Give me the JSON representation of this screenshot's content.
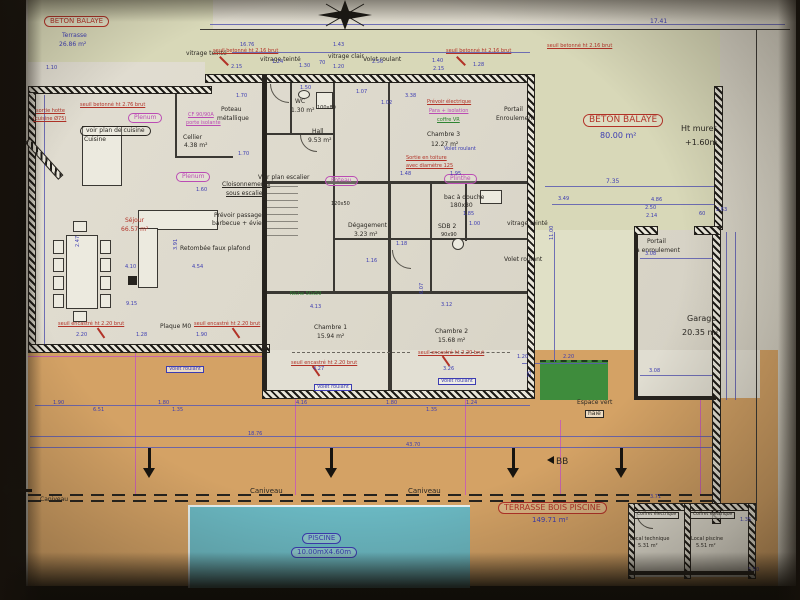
{
  "document": {
    "kind": "architectural floor plan (photograph)",
    "section_mark": "BB"
  },
  "palette": {
    "blue": "#3c3cb2",
    "red": "#b23227",
    "mag": "#bb4cb4",
    "blk": "#2a2722",
    "grn": "#2e8432",
    "paper": "#ddd9cd",
    "khaki": "#d8d8b8",
    "tan": "#d4a265",
    "pool": "#6ab8c2",
    "green": "#3e8c3c",
    "wall": "#26231e"
  },
  "rooms": [
    {
      "name": "Séjour",
      "area": "66.57 m²"
    },
    {
      "name": "Cuisine",
      "area": ""
    },
    {
      "name": "Cellier",
      "area": "4.38 m²"
    },
    {
      "name": "WC",
      "area": "1.30 m²"
    },
    {
      "name": "Hall",
      "area": "9.53 m²"
    },
    {
      "name": "Dégagement",
      "area": "3.23 m²"
    },
    {
      "name": "SDB 2",
      "area": ""
    },
    {
      "name": "Chambre 1",
      "area": "15.94 m²"
    },
    {
      "name": "Chambre 2",
      "area": "15.68 m²"
    },
    {
      "name": "Chambre 3",
      "area": "12.27 m²"
    },
    {
      "name": "Garage",
      "area": "20.35 m²"
    },
    {
      "name": "Local technique",
      "area": "5.31 m²"
    },
    {
      "name": "Local piscine",
      "area": "5.51 m²"
    },
    {
      "name": "Terrasse béton balayé",
      "area": "26.86 m²"
    },
    {
      "name": "Béton balayé",
      "area": "80.00 m²"
    },
    {
      "name": "Terrasse bois piscine",
      "area": "149.71 m²"
    },
    {
      "name": "Piscine",
      "area": "10.00mX4.60m"
    }
  ],
  "labels": [
    {
      "t": "BETON BALAYE",
      "x": 44,
      "y": 16,
      "s": 7,
      "c": "red",
      "o": 1,
      "n": "beton-balaye-nw-title"
    },
    {
      "t": "Terrasse",
      "x": 62,
      "y": 33,
      "s": 6,
      "c": "blue"
    },
    {
      "t": "26.86 m²",
      "x": 59,
      "y": 42,
      "s": 6,
      "c": "blue"
    },
    {
      "t": "BETON BALAYE",
      "x": 583,
      "y": 114,
      "s": 9,
      "c": "red",
      "o": 1,
      "n": "beton-balaye-e-title"
    },
    {
      "t": "80.00 m²",
      "x": 600,
      "y": 132,
      "s": 8,
      "c": "blue"
    },
    {
      "t": "TERRASSE BOIS PISCINE",
      "x": 498,
      "y": 502,
      "s": 8,
      "c": "red",
      "o": 1,
      "n": "terrasse-bois-title"
    },
    {
      "t": "149.71 m²",
      "x": 532,
      "y": 517,
      "s": 7,
      "c": "blue"
    },
    {
      "t": "PISCINE",
      "x": 302,
      "y": 533,
      "s": 7,
      "c": "blue",
      "o": 1,
      "n": "piscine-title"
    },
    {
      "t": "10.00mX4.60m",
      "x": 291,
      "y": 547,
      "s": 7,
      "c": "blue",
      "o": 1
    },
    {
      "t": "voir plan de cuisine",
      "x": 80,
      "y": 126,
      "s": 6,
      "c": "blk",
      "o": 1
    },
    {
      "t": "Plenum",
      "x": 128,
      "y": 113,
      "s": 6,
      "c": "mag",
      "o": 1
    },
    {
      "t": "Plenum",
      "x": 176,
      "y": 172,
      "s": 6,
      "c": "mag",
      "o": 1
    },
    {
      "t": "Poteau",
      "x": 325,
      "y": 176,
      "s": 6,
      "c": "mag",
      "o": 1
    },
    {
      "t": "Plinthe",
      "x": 444,
      "y": 174,
      "s": 6,
      "c": "mag",
      "o": 1
    },
    {
      "t": "Ht muret",
      "x": 681,
      "y": 125,
      "s": 8,
      "c": "blk"
    },
    {
      "t": "+1.60m",
      "x": 685,
      "y": 139,
      "s": 8,
      "c": "blk"
    },
    {
      "t": "Garage",
      "x": 687,
      "y": 315,
      "s": 8,
      "c": "blk"
    },
    {
      "t": "20.35 m²",
      "x": 682,
      "y": 329,
      "s": 8,
      "c": "blk"
    },
    {
      "t": "Portail",
      "x": 647,
      "y": 239,
      "s": 6,
      "c": "blk"
    },
    {
      "t": "à enroulement",
      "x": 636,
      "y": 248,
      "s": 6,
      "c": "blk"
    },
    {
      "t": "Portail",
      "x": 504,
      "y": 107,
      "s": 6,
      "c": "blk"
    },
    {
      "t": "Enroulement",
      "x": 496,
      "y": 116,
      "s": 6,
      "c": "blk"
    },
    {
      "t": "Espace vert",
      "x": 577,
      "y": 400,
      "s": 6,
      "c": "blk"
    },
    {
      "t": "haie",
      "x": 585,
      "y": 410,
      "s": 6,
      "c": "blk",
      "b": 1
    },
    {
      "t": "Caniveau",
      "x": 250,
      "y": 488,
      "s": 7,
      "c": "blk"
    },
    {
      "t": "Caniveau",
      "x": 408,
      "y": 488,
      "s": 7,
      "c": "blk"
    },
    {
      "t": "Caniveau",
      "x": 40,
      "y": 497,
      "s": 6,
      "c": "blk"
    },
    {
      "t": "BB",
      "x": 556,
      "y": 458,
      "s": 9,
      "c": "blk",
      "n": "section-mark-bb"
    },
    {
      "t": "Poteau",
      "x": 221,
      "y": 107,
      "s": 6,
      "c": "blk"
    },
    {
      "t": "métallique",
      "x": 217,
      "y": 116,
      "s": 6,
      "c": "blk"
    },
    {
      "t": "Cloisonnements",
      "x": 222,
      "y": 182,
      "s": 6,
      "c": "blk",
      "u": 1
    },
    {
      "t": "sous escalier",
      "x": 226,
      "y": 191,
      "s": 6,
      "c": "blk",
      "u": 1
    },
    {
      "t": "Voir plan escalier",
      "x": 258,
      "y": 175,
      "s": 6,
      "c": "blk"
    },
    {
      "t": "Retombée faux plafond",
      "x": 180,
      "y": 246,
      "s": 6,
      "c": "blk"
    },
    {
      "t": "Prévoir passage",
      "x": 214,
      "y": 213,
      "s": 6,
      "c": "blk"
    },
    {
      "t": "barbecue + évier",
      "x": 212,
      "y": 221,
      "s": 6,
      "c": "blk"
    },
    {
      "t": "Plaque M0",
      "x": 160,
      "y": 324,
      "s": 6,
      "c": "blk"
    },
    {
      "t": "Cuisine",
      "x": 84,
      "y": 137,
      "s": 6,
      "c": "blk"
    },
    {
      "t": "Cellier",
      "x": 183,
      "y": 135,
      "s": 6,
      "c": "blk"
    },
    {
      "t": "4.38 m²",
      "x": 184,
      "y": 143,
      "s": 6,
      "c": "blk"
    },
    {
      "t": "vitrage teinté",
      "x": 186,
      "y": 51,
      "s": 6,
      "c": "blk"
    },
    {
      "t": "vitrage teinté",
      "x": 260,
      "y": 57,
      "s": 6,
      "c": "blk"
    },
    {
      "t": "vitrage clair",
      "x": 328,
      "y": 54,
      "s": 6,
      "c": "blk"
    },
    {
      "t": "Volet roulant",
      "x": 363,
      "y": 57,
      "s": 6,
      "c": "blk"
    },
    {
      "t": "vitrage teinté",
      "x": 507,
      "y": 221,
      "s": 6,
      "c": "blk"
    },
    {
      "t": "Volet roulant",
      "x": 504,
      "y": 257,
      "s": 6,
      "c": "blk"
    },
    {
      "t": "WC",
      "x": 295,
      "y": 99,
      "s": 6,
      "c": "blk"
    },
    {
      "t": "1.30 m²",
      "x": 291,
      "y": 108,
      "s": 6,
      "c": "blk"
    },
    {
      "t": "100x80",
      "x": 317,
      "y": 106,
      "s": 5,
      "c": "blk"
    },
    {
      "t": "Hall",
      "x": 312,
      "y": 129,
      "s": 6,
      "c": "blk"
    },
    {
      "t": "9.53 m²",
      "x": 308,
      "y": 138,
      "s": 6,
      "c": "blk"
    },
    {
      "t": "Chambre 3",
      "x": 427,
      "y": 132,
      "s": 6,
      "c": "blk"
    },
    {
      "t": "12.27 m²",
      "x": 431,
      "y": 142,
      "s": 6,
      "c": "blk"
    },
    {
      "t": "Chambre 1",
      "x": 314,
      "y": 325,
      "s": 6,
      "c": "blk"
    },
    {
      "t": "15.94 m²",
      "x": 317,
      "y": 334,
      "s": 6,
      "c": "blk"
    },
    {
      "t": "Chambre 2",
      "x": 435,
      "y": 329,
      "s": 6,
      "c": "blk"
    },
    {
      "t": "15.68 m²",
      "x": 438,
      "y": 338,
      "s": 6,
      "c": "blk"
    },
    {
      "t": "Dégagement",
      "x": 348,
      "y": 223,
      "s": 6,
      "c": "blk"
    },
    {
      "t": "3.23 m²",
      "x": 354,
      "y": 232,
      "s": 6,
      "c": "blk"
    },
    {
      "t": "bac à douche",
      "x": 444,
      "y": 195,
      "s": 6,
      "c": "blk"
    },
    {
      "t": "180x80",
      "x": 450,
      "y": 203,
      "s": 6,
      "c": "blk"
    },
    {
      "t": "SDB 2",
      "x": 438,
      "y": 224,
      "s": 6,
      "c": "blk"
    },
    {
      "t": "90x90",
      "x": 441,
      "y": 233,
      "s": 5,
      "c": "blk"
    },
    {
      "t": "120x50",
      "x": 331,
      "y": 202,
      "s": 5,
      "c": "blk"
    },
    {
      "t": "Local technique",
      "x": 630,
      "y": 537,
      "s": 5,
      "c": "blk"
    },
    {
      "t": "5.31 m²",
      "x": 638,
      "y": 544,
      "s": 5,
      "c": "blk"
    },
    {
      "t": "Local piscine",
      "x": 691,
      "y": 537,
      "s": 5,
      "c": "blk"
    },
    {
      "t": "5.51 m²",
      "x": 696,
      "y": 544,
      "s": 5,
      "c": "blk"
    },
    {
      "t": "Coffret électrique",
      "x": 634,
      "y": 512,
      "s": 4.5,
      "c": "blk",
      "b": 1
    },
    {
      "t": "Coffret électrique",
      "x": 690,
      "y": 512,
      "s": 4.5,
      "c": "blk",
      "b": 1
    },
    {
      "t": "seuil betonné ht 2.16 brut",
      "x": 213,
      "y": 49,
      "s": 5,
      "c": "red",
      "u": 1
    },
    {
      "t": "seuil betonné ht 2.16 brut",
      "x": 446,
      "y": 49,
      "s": 5,
      "c": "red",
      "u": 1
    },
    {
      "t": "seuil betonné ht 2.16 brut",
      "x": 547,
      "y": 44,
      "s": 5,
      "c": "red",
      "u": 1
    },
    {
      "t": "seuil betonné ht 2.76 brut",
      "x": 80,
      "y": 103,
      "s": 5,
      "c": "red",
      "u": 1
    },
    {
      "t": "sortie hotte",
      "x": 36,
      "y": 109,
      "s": 5,
      "c": "red",
      "u": 1
    },
    {
      "t": "(cuisine Ø75)",
      "x": 33,
      "y": 117,
      "s": 5,
      "c": "red",
      "u": 1
    },
    {
      "t": "seuil encastré ht 2.20 brut",
      "x": 58,
      "y": 322,
      "s": 5,
      "c": "red",
      "u": 1
    },
    {
      "t": "seuil encastré ht 2.20 brut",
      "x": 194,
      "y": 322,
      "s": 5,
      "c": "red",
      "u": 1
    },
    {
      "t": "seuil encastré ht 2.20 brut",
      "x": 291,
      "y": 361,
      "s": 5,
      "c": "red",
      "u": 1
    },
    {
      "t": "seuil encastré ht 2.20 brut",
      "x": 418,
      "y": 351,
      "s": 5,
      "c": "red",
      "u": 1
    },
    {
      "t": "Sortie en toiture",
      "x": 406,
      "y": 156,
      "s": 5,
      "c": "red",
      "u": 1
    },
    {
      "t": "avec diamètre 125",
      "x": 406,
      "y": 164,
      "s": 5,
      "c": "red",
      "u": 1
    },
    {
      "t": "Prévoir électrique",
      "x": 427,
      "y": 100,
      "s": 5,
      "c": "red",
      "u": 1
    },
    {
      "t": "Para + isolation",
      "x": 429,
      "y": 109,
      "s": 5,
      "c": "mag",
      "u": 1
    },
    {
      "t": "coffre VR",
      "x": 437,
      "y": 118,
      "s": 5,
      "c": "grn",
      "u": 1
    },
    {
      "t": "CF 90/90A",
      "x": 188,
      "y": 113,
      "s": 5,
      "c": "mag",
      "u": 1
    },
    {
      "t": "porte isolante",
      "x": 186,
      "y": 121,
      "s": 5,
      "c": "mag",
      "u": 1
    },
    {
      "t": "Séjour",
      "x": 125,
      "y": 218,
      "s": 6,
      "c": "red"
    },
    {
      "t": "66.57 m²",
      "x": 121,
      "y": 227,
      "s": 6,
      "c": "red"
    },
    {
      "t": "Niche 50x50",
      "x": 290,
      "y": 292,
      "s": 5,
      "c": "grn"
    },
    {
      "t": "Volet roulant",
      "x": 166,
      "y": 366,
      "s": 5,
      "c": "blue",
      "b": 1
    },
    {
      "t": "Volet roulant",
      "x": 314,
      "y": 384,
      "s": 5,
      "c": "blue",
      "b": 1
    },
    {
      "t": "Volet roulant",
      "x": 438,
      "y": 378,
      "s": 5,
      "c": "blue",
      "b": 1
    },
    {
      "t": "Volet roulant",
      "x": 444,
      "y": 147,
      "s": 5,
      "c": "blue"
    },
    {
      "t": "17.41",
      "x": 650,
      "y": 19,
      "s": 6,
      "c": "blue"
    },
    {
      "t": "16.76",
      "x": 240,
      "y": 43,
      "s": 5,
      "c": "blue"
    },
    {
      "t": "2.15",
      "x": 231,
      "y": 65,
      "s": 5,
      "c": "blue"
    },
    {
      "t": "1.24",
      "x": 272,
      "y": 60,
      "s": 5,
      "c": "blue"
    },
    {
      "t": "1.30",
      "x": 299,
      "y": 64,
      "s": 5,
      "c": "blue"
    },
    {
      "t": "70",
      "x": 319,
      "y": 61,
      "s": 5,
      "c": "blue"
    },
    {
      "t": "1.20",
      "x": 333,
      "y": 65,
      "s": 5,
      "c": "blue"
    },
    {
      "t": "2.56",
      "x": 372,
      "y": 60,
      "s": 5,
      "c": "blue"
    },
    {
      "t": "1.43",
      "x": 333,
      "y": 43,
      "s": 5,
      "c": "blue"
    },
    {
      "t": "1.40",
      "x": 432,
      "y": 59,
      "s": 5,
      "c": "blue"
    },
    {
      "t": "2.15",
      "x": 433,
      "y": 67,
      "s": 5,
      "c": "blue"
    },
    {
      "t": "1.28",
      "x": 473,
      "y": 63,
      "s": 5,
      "c": "blue"
    },
    {
      "t": "1.10",
      "x": 46,
      "y": 66,
      "s": 5,
      "c": "blue"
    },
    {
      "t": "7.35",
      "x": 606,
      "y": 179,
      "s": 6,
      "c": "blue"
    },
    {
      "t": "3.49",
      "x": 558,
      "y": 197,
      "s": 5,
      "c": "blue"
    },
    {
      "t": "4.86",
      "x": 651,
      "y": 198,
      "s": 5,
      "c": "blue"
    },
    {
      "t": "2.50",
      "x": 645,
      "y": 206,
      "s": 5,
      "c": "blue"
    },
    {
      "t": "2.14",
      "x": 646,
      "y": 214,
      "s": 5,
      "c": "blue"
    },
    {
      "t": "60",
      "x": 699,
      "y": 212,
      "s": 5,
      "c": "blue"
    },
    {
      "t": "2.63",
      "x": 716,
      "y": 208,
      "s": 5,
      "c": "blue"
    },
    {
      "t": "3.08",
      "x": 645,
      "y": 252,
      "s": 5,
      "c": "blue"
    },
    {
      "t": "3.08",
      "x": 649,
      "y": 369,
      "s": 5,
      "c": "blue"
    },
    {
      "t": "11.00",
      "x": 550,
      "y": 240,
      "s": 5,
      "c": "blue",
      "r": -90
    },
    {
      "t": "2.47",
      "x": 76,
      "y": 247,
      "s": 5,
      "c": "blue",
      "r": -90
    },
    {
      "t": "3.91",
      "x": 174,
      "y": 250,
      "s": 5,
      "c": "blue",
      "r": -90
    },
    {
      "t": "4.54",
      "x": 192,
      "y": 265,
      "s": 5,
      "c": "blue"
    },
    {
      "t": "4.10",
      "x": 125,
      "y": 265,
      "s": 5,
      "c": "blue"
    },
    {
      "t": "9.15",
      "x": 126,
      "y": 302,
      "s": 5,
      "c": "blue"
    },
    {
      "t": "4.13",
      "x": 310,
      "y": 305,
      "s": 5,
      "c": "blue"
    },
    {
      "t": "4.27",
      "x": 313,
      "y": 367,
      "s": 5,
      "c": "blue"
    },
    {
      "t": "3.12",
      "x": 441,
      "y": 303,
      "s": 5,
      "c": "blue"
    },
    {
      "t": "3.26",
      "x": 443,
      "y": 367,
      "s": 5,
      "c": "blue"
    },
    {
      "t": "1.20",
      "x": 517,
      "y": 355,
      "s": 5,
      "c": "blue"
    },
    {
      "t": "2.20",
      "x": 563,
      "y": 355,
      "s": 5,
      "c": "blue"
    },
    {
      "t": "55",
      "x": 528,
      "y": 377,
      "s": 5,
      "c": "blue",
      "r": -90
    },
    {
      "t": "1.90",
      "x": 53,
      "y": 401,
      "s": 5,
      "c": "blue"
    },
    {
      "t": "6.51",
      "x": 93,
      "y": 408,
      "s": 5,
      "c": "blue"
    },
    {
      "t": "1.80",
      "x": 158,
      "y": 401,
      "s": 5,
      "c": "blue"
    },
    {
      "t": "1.35",
      "x": 172,
      "y": 408,
      "s": 5,
      "c": "blue"
    },
    {
      "t": "4.16",
      "x": 296,
      "y": 401,
      "s": 5,
      "c": "blue"
    },
    {
      "t": "1.80",
      "x": 386,
      "y": 401,
      "s": 5,
      "c": "blue"
    },
    {
      "t": "1.35",
      "x": 426,
      "y": 408,
      "s": 5,
      "c": "blue"
    },
    {
      "t": "1.24",
      "x": 466,
      "y": 401,
      "s": 5,
      "c": "blue"
    },
    {
      "t": "18.76",
      "x": 248,
      "y": 432,
      "s": 5,
      "c": "blue"
    },
    {
      "t": "43.70",
      "x": 406,
      "y": 443,
      "s": 5,
      "c": "blue"
    },
    {
      "t": "3.71",
      "x": 650,
      "y": 495,
      "s": 5,
      "c": "blue"
    },
    {
      "t": "1.35",
      "x": 740,
      "y": 518,
      "s": 5,
      "c": "blue"
    },
    {
      "t": "5.50",
      "x": 748,
      "y": 568,
      "s": 5,
      "c": "blue"
    },
    {
      "t": "2.20",
      "x": 76,
      "y": 333,
      "s": 5,
      "c": "blue"
    },
    {
      "t": "1.28",
      "x": 136,
      "y": 333,
      "s": 5,
      "c": "blue"
    },
    {
      "t": "1.90",
      "x": 196,
      "y": 333,
      "s": 5,
      "c": "blue"
    },
    {
      "t": "1.70",
      "x": 238,
      "y": 152,
      "s": 5,
      "c": "blue"
    },
    {
      "t": "1.60",
      "x": 196,
      "y": 188,
      "s": 5,
      "c": "blue"
    },
    {
      "t": "1.70",
      "x": 236,
      "y": 94,
      "s": 5,
      "c": "blue"
    },
    {
      "t": "1.50",
      "x": 300,
      "y": 86,
      "s": 5,
      "c": "blue"
    },
    {
      "t": "1.07",
      "x": 356,
      "y": 90,
      "s": 5,
      "c": "blue"
    },
    {
      "t": "1.02",
      "x": 381,
      "y": 101,
      "s": 5,
      "c": "blue"
    },
    {
      "t": "3.38",
      "x": 405,
      "y": 94,
      "s": 5,
      "c": "blue"
    },
    {
      "t": "1.48",
      "x": 400,
      "y": 172,
      "s": 5,
      "c": "blue"
    },
    {
      "t": "1.95",
      "x": 450,
      "y": 172,
      "s": 5,
      "c": "blue"
    },
    {
      "t": "1.18",
      "x": 396,
      "y": 242,
      "s": 5,
      "c": "blue"
    },
    {
      "t": "1.16",
      "x": 366,
      "y": 259,
      "s": 5,
      "c": "blue"
    },
    {
      "t": "6.07",
      "x": 420,
      "y": 294,
      "s": 5,
      "c": "blue",
      "r": -90
    },
    {
      "t": "1.85",
      "x": 463,
      "y": 212,
      "s": 5,
      "c": "blue"
    },
    {
      "t": "1.00",
      "x": 469,
      "y": 222,
      "s": 5,
      "c": "blue"
    }
  ],
  "arrows": [
    {
      "x": 148,
      "y": 448,
      "d": "down"
    },
    {
      "x": 330,
      "y": 448,
      "d": "down"
    },
    {
      "x": 512,
      "y": 448,
      "d": "down"
    },
    {
      "x": 620,
      "y": 448,
      "d": "down"
    },
    {
      "x": 8,
      "y": 489,
      "d": "left"
    },
    {
      "x": 543,
      "y": 456,
      "d": "left-small"
    }
  ]
}
